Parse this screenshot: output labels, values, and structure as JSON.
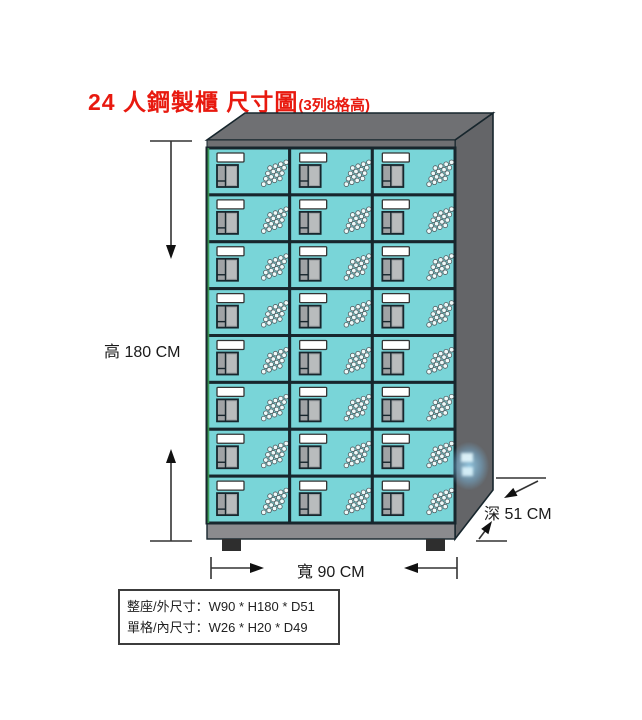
{
  "title": {
    "main": "24 人鋼製櫃 尺寸圖",
    "sub": "(3列8格高)"
  },
  "cabinet": {
    "rows": 8,
    "cols": 3,
    "layout_note": "3列8格高"
  },
  "dimensions": {
    "height_label": "高 180 CM",
    "width_label": "寬 90 CM",
    "depth_label": "深 51 CM"
  },
  "spec_box": {
    "overall": "整座/外尺寸：W90 * H180 * D51",
    "compartment": "單格/內尺寸：W26 * H20 * D49"
  },
  "colors": {
    "title": "#e8190f",
    "door": "#79d5d8",
    "line": "#17262d",
    "top": "#6f7073",
    "side": "#646568",
    "base": "#8b8b8e",
    "foot": "#2e2e2e",
    "plate": "#ffffff",
    "handle": "#a0a3a5",
    "vent": "#eefafa",
    "dim_text": "#1a1a1a",
    "edge_highlight": "#3aa054"
  }
}
